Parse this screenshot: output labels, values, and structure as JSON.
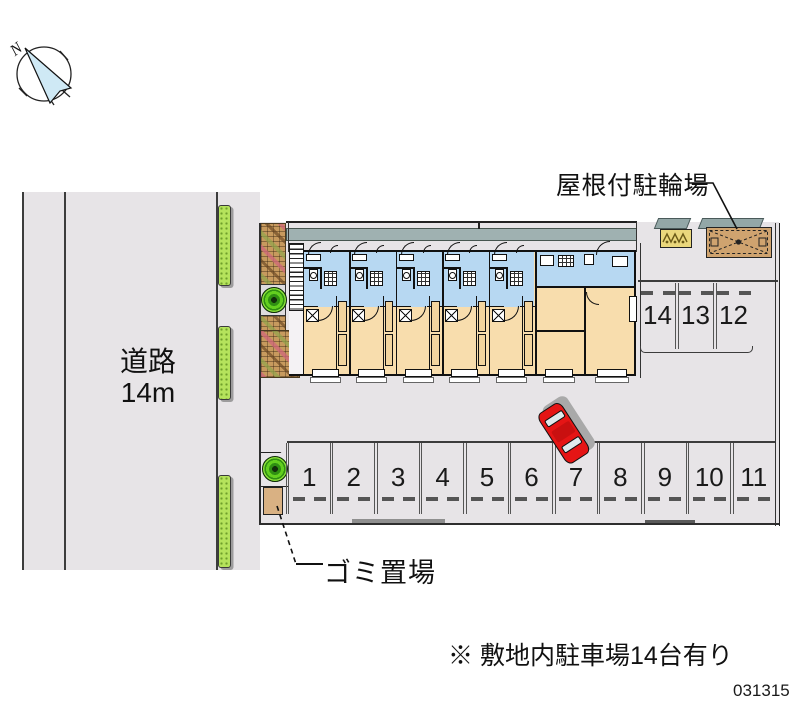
{
  "compass": {
    "north_label": "N"
  },
  "road": {
    "name": "道路",
    "width": "14m"
  },
  "site": {
    "bike_parking_label": "屋根付駐輪場",
    "garbage_label": "ゴミ置場",
    "note": "※ 敷地内駐車場14台有り",
    "drawing_number": "031315"
  },
  "parking": {
    "bottom_row_spaces": [
      "1",
      "2",
      "3",
      "4",
      "5",
      "6",
      "7",
      "8",
      "9",
      "10",
      "11"
    ],
    "right_row_spaces": [
      "14",
      "13",
      "12"
    ],
    "total_spaces": "14"
  },
  "building": {
    "narrow_units": 5,
    "corner_units": 1
  },
  "colors": {
    "surface_gray": "#e7e4e7",
    "room_tan": "#f8ddad",
    "wet_area_blue": "#b7d8f2",
    "eave_teal": "#9fb1b1",
    "hedge_green": "#b5e35c",
    "tree_green": "#55c81e",
    "shed_brown": "#cfa36f",
    "rack_yellow": "#ead77c",
    "car_red": "#e51515",
    "garbage_tan": "#d9b183",
    "line_dark": "#1a1a1a"
  }
}
